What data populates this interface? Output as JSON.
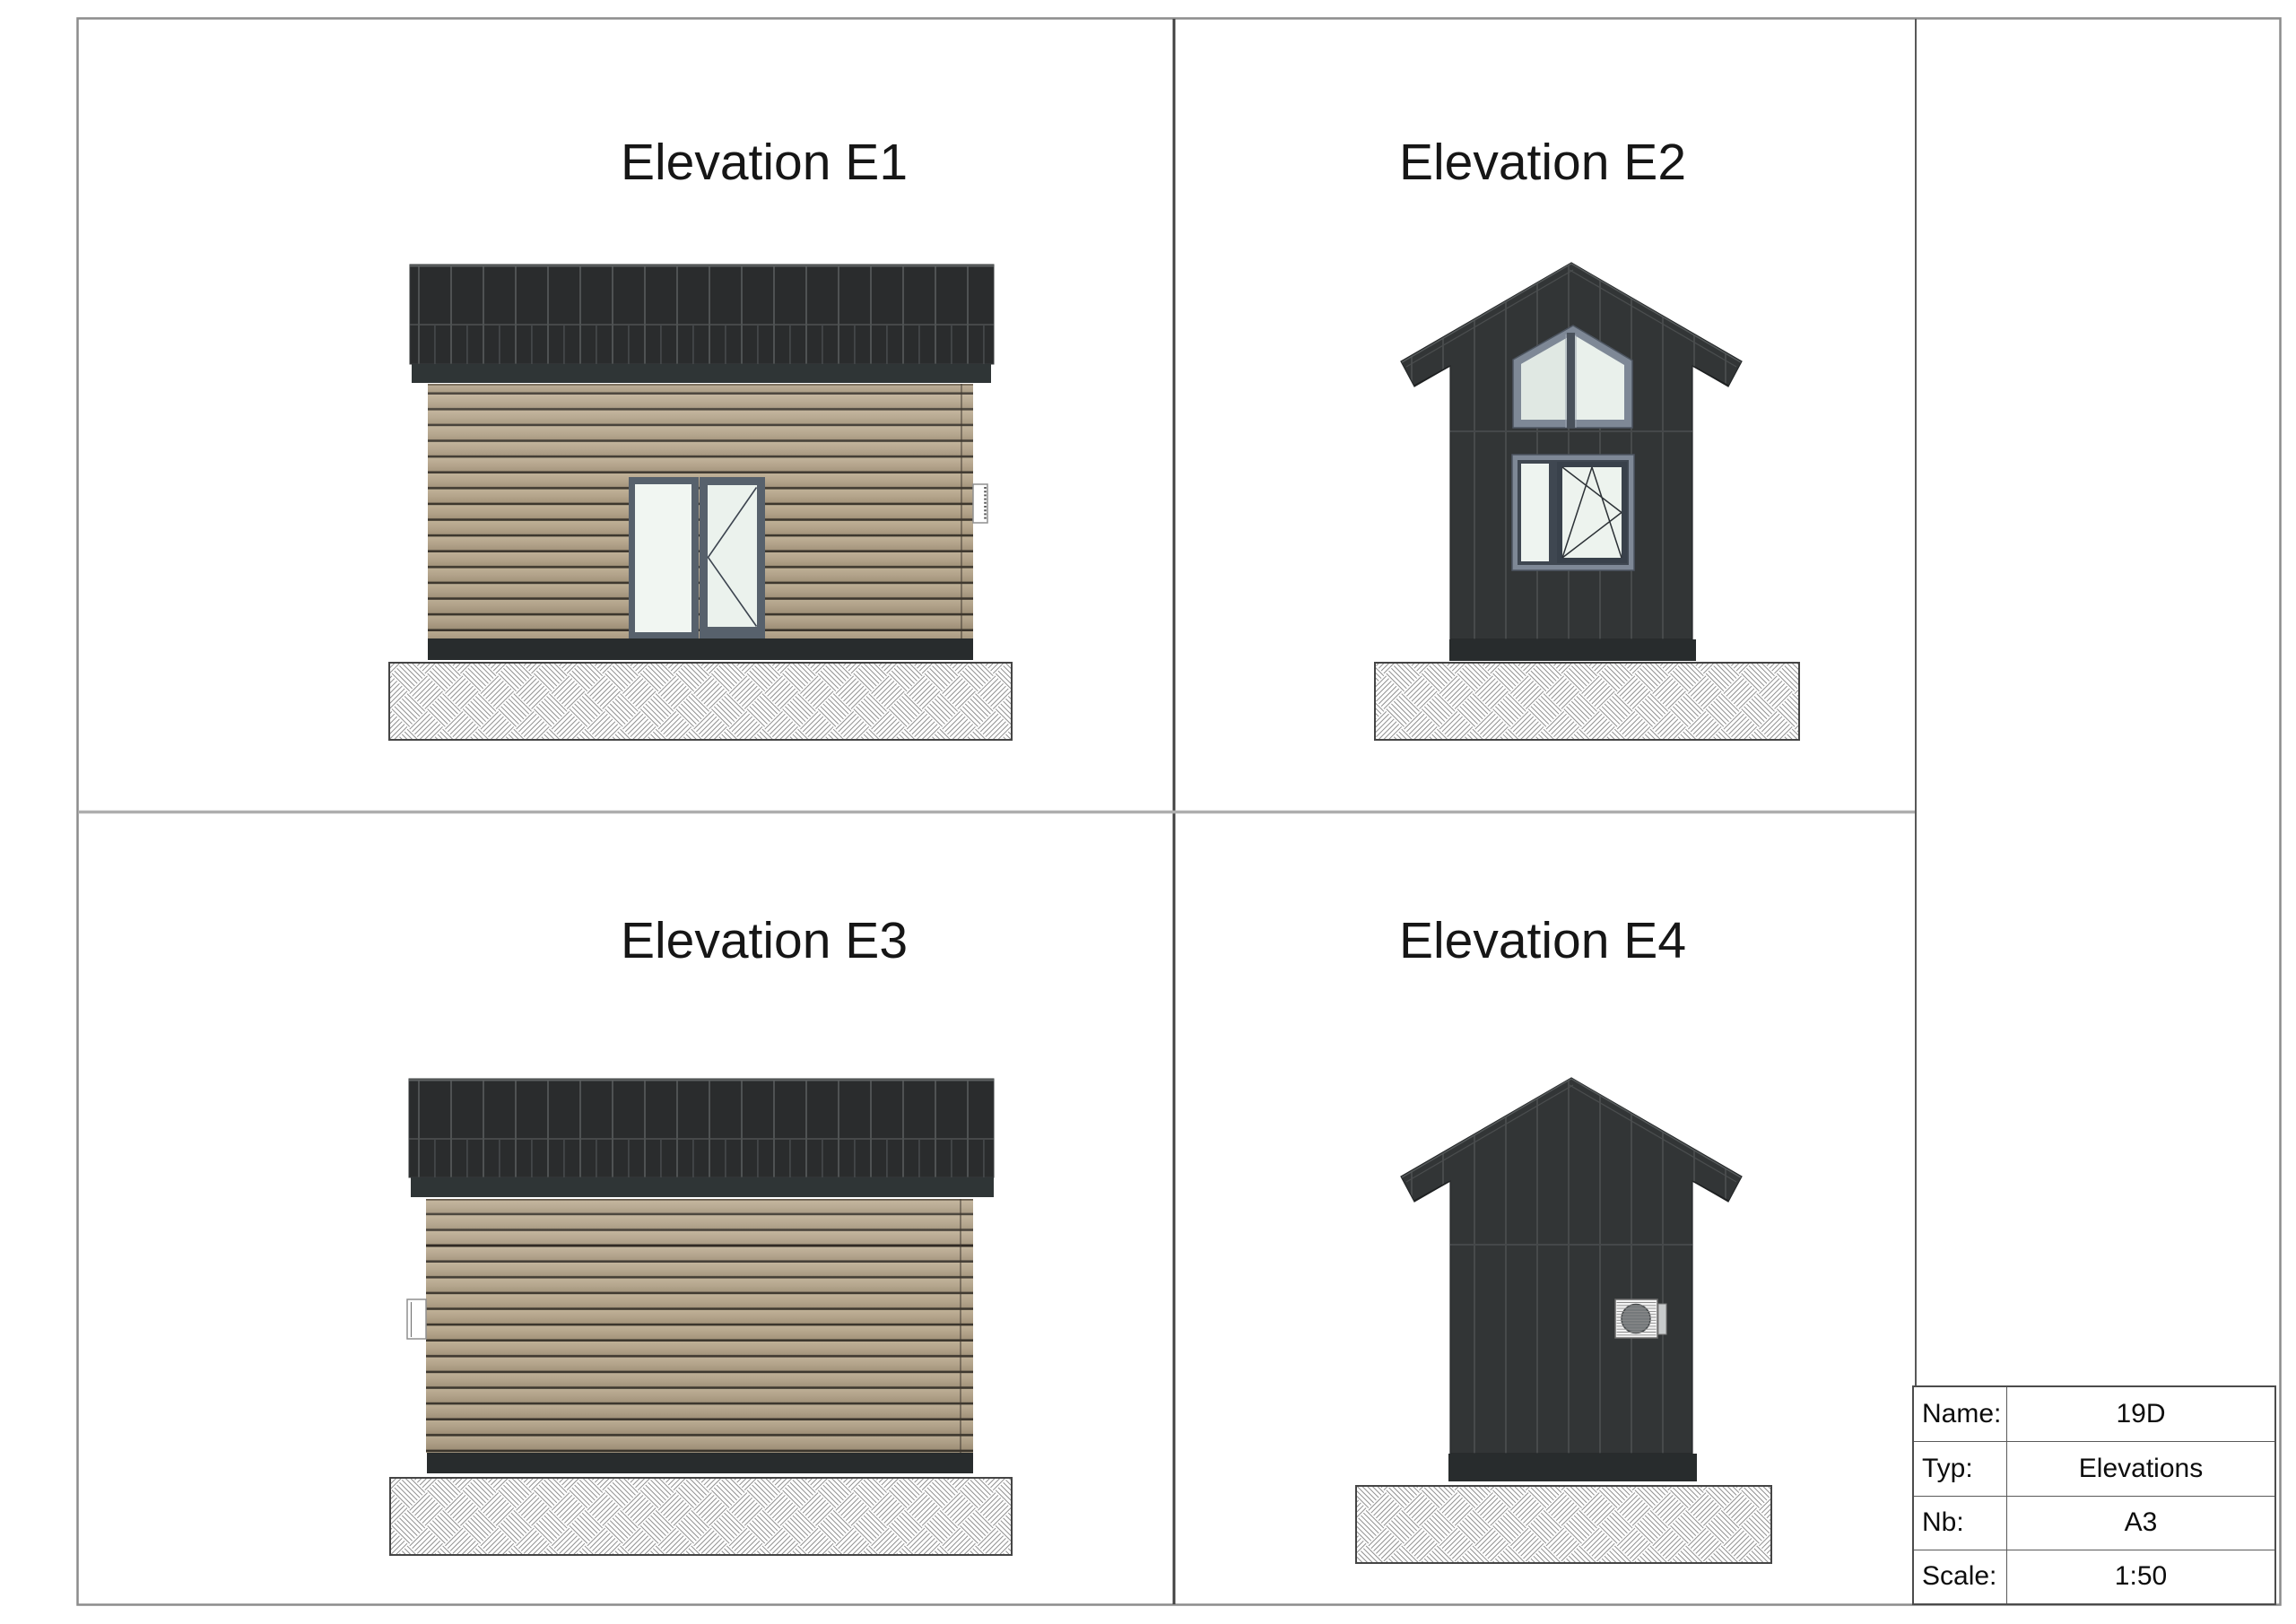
{
  "sheet": {
    "type": "architectural elevation drawing sheet",
    "scale_note": "1:50"
  },
  "elevations": [
    {
      "id": "E1",
      "title": "Elevation E1",
      "view": "side elevation with entry door"
    },
    {
      "id": "E2",
      "title": "Elevation E2",
      "view": "gable elevation with gable window and tilt-turn window"
    },
    {
      "id": "E3",
      "title": "Elevation E3",
      "view": "side elevation with wall vent"
    },
    {
      "id": "E4",
      "title": "Elevation E4",
      "view": "gable elevation with exterior vent unit"
    }
  ],
  "title_block": {
    "rows": [
      {
        "label": "Name:",
        "value": "19D"
      },
      {
        "label": "Typ:",
        "value": "Elevations"
      },
      {
        "label": "Nb:",
        "value": "A3"
      },
      {
        "label": "Scale:",
        "value": "1:50"
      }
    ]
  },
  "colors": {
    "roof_dark": "#2a2c2d",
    "roof_seam": "#4f5253",
    "fascia": "#2f3536",
    "dark_siding": "#323536",
    "dark_siding_seam": "#474a4b",
    "wood_siding": "#b4a48b",
    "wood_gap_line": "#3c362d",
    "plinth": "#282c2d",
    "window_frame_light": "#7e8896",
    "window_sash_dark": "#3f4751",
    "glass": "#edf3ee",
    "hatch_line": "#8f8f8f",
    "frame_border": "#8c8c8c",
    "divider_dark": "#414141",
    "divider_light": "#aeaeae",
    "text": "#161616"
  }
}
